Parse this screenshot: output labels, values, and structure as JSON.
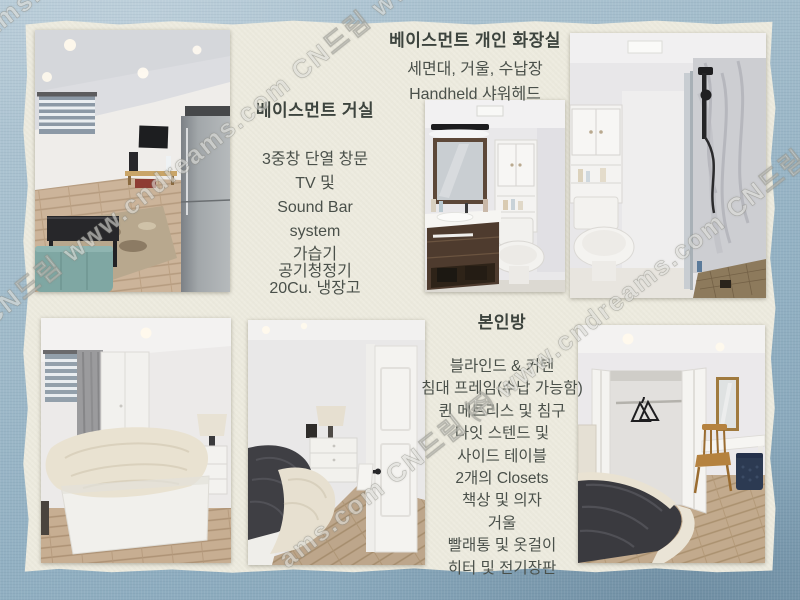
{
  "sections": {
    "living_room": {
      "title": "베이스먼트 거실",
      "items": [
        "3중창 단열 창문",
        "TV 및",
        "Sound Bar",
        "system",
        "가습기",
        "공기청정기",
        "20Cu. 냉장고"
      ]
    },
    "bathroom": {
      "title": "베이스먼트 개인 화장실",
      "items": [
        "세면대, 거울, 수납장",
        "Handheld  샤워헤드"
      ]
    },
    "main_bedroom": {
      "title": "본인방",
      "items": [
        "블라인드 & 커텐",
        "침대 프레임(수납 가능함)",
        "퀸 메트리스 및 침구",
        "나잇 스텐드 및",
        "사이드 테이블",
        "2개의 Closets",
        "책상 및 의자",
        "거울",
        "빨래통 및 옷걸이",
        "히터 및 전기장판"
      ]
    }
  },
  "watermark": {
    "brand": "CN드림",
    "site": "www.cndreams.com",
    "band_upper": "CN드림 www.cndreams.com  CN드림 www.cndreams.c",
    "band_lower": "ams.com  CN드림 ㈜  www.cndreams.com  CN드림",
    "band_corner": "reams.co"
  },
  "photos": [
    {
      "name": "basement-living-room"
    },
    {
      "name": "bathroom-vanity-and-toilet"
    },
    {
      "name": "bathroom-shower"
    },
    {
      "name": "bedroom-queen-bed"
    },
    {
      "name": "bedroom-nightstand-and-door"
    },
    {
      "name": "bedroom-closet-and-desk"
    }
  ],
  "colors": {
    "frame_blue": "#9db8c8",
    "card_cream": "#edebdf",
    "text": "#4a504a"
  }
}
